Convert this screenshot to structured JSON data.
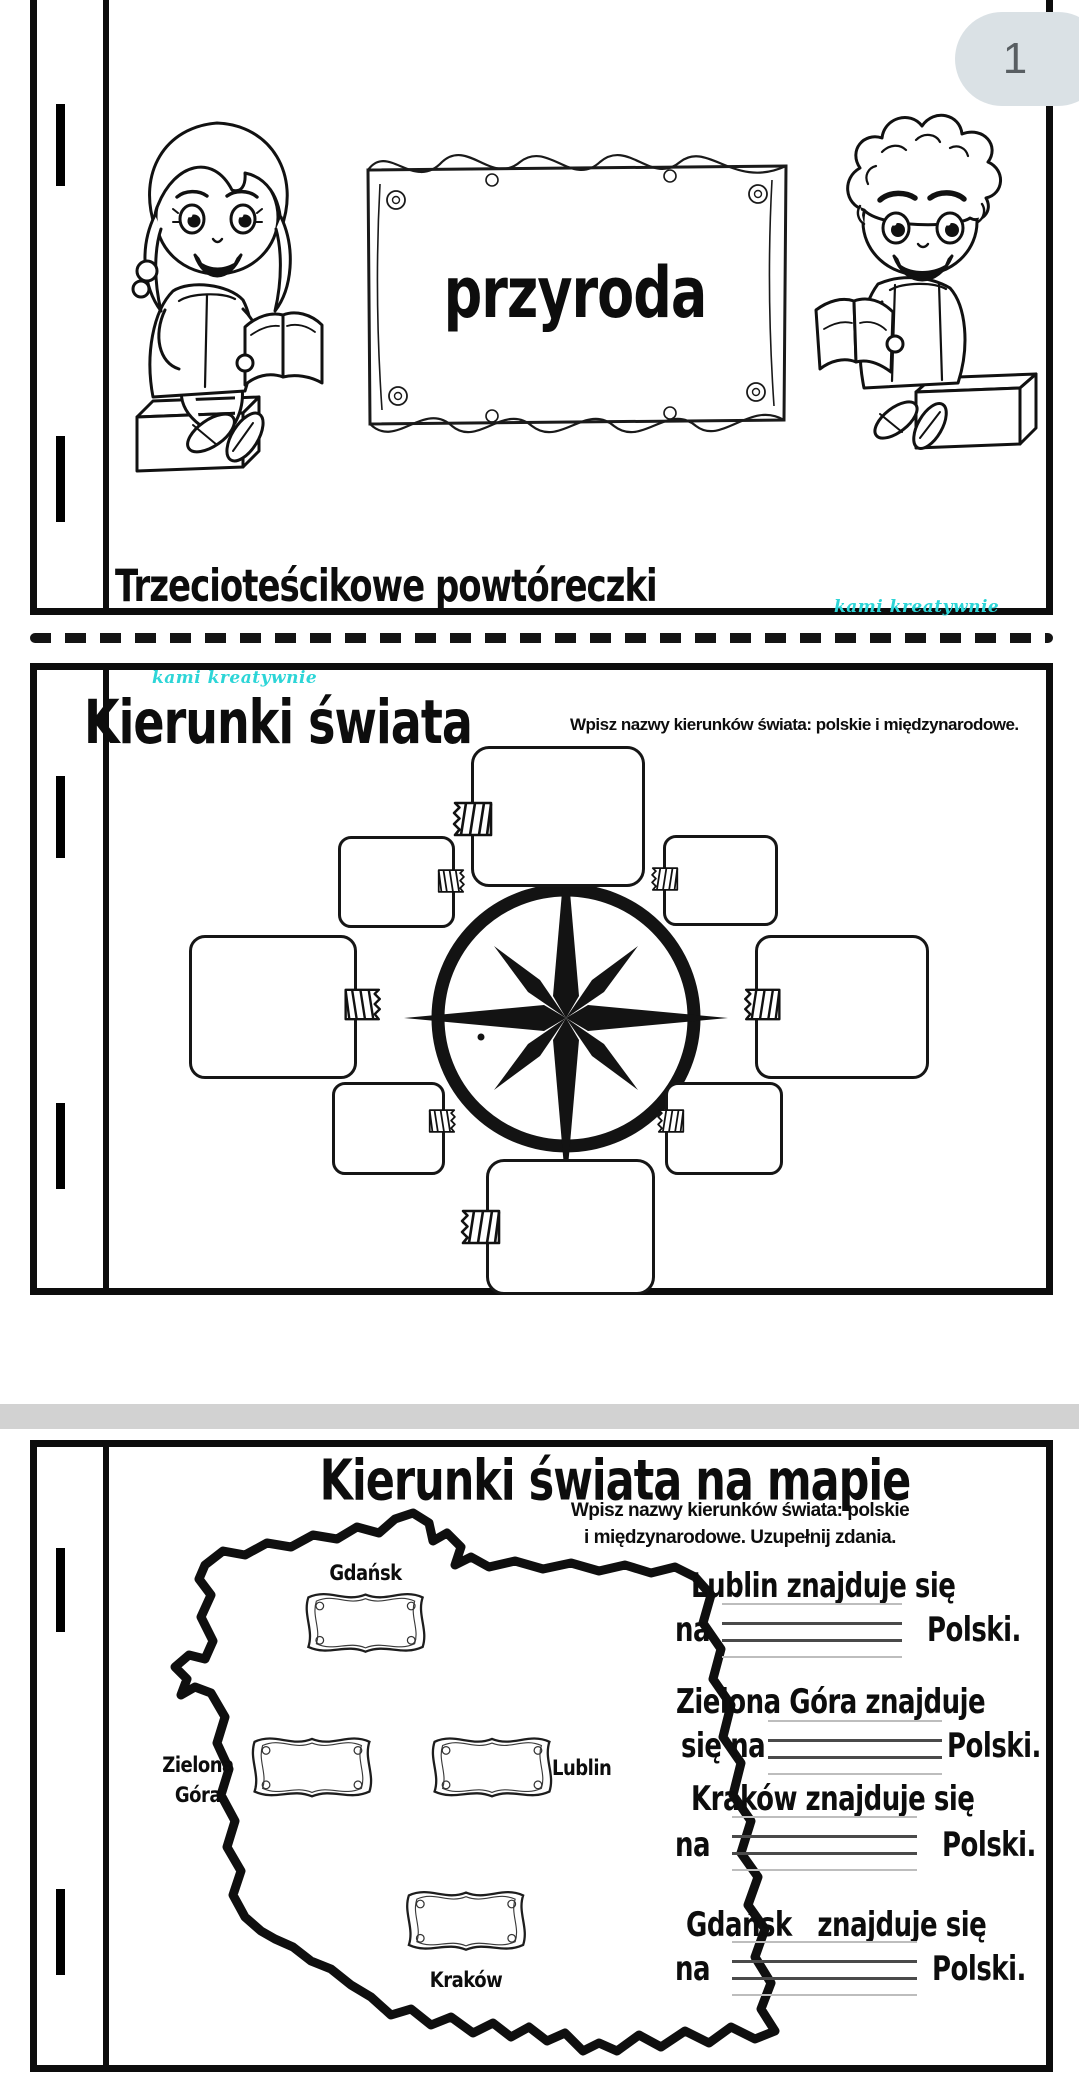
{
  "viewer": {
    "page_badge": "1",
    "badge_bg": "#dae1e5",
    "badge_text_color": "#585e62"
  },
  "brand": {
    "watermark": "kami kreatywnie",
    "accent_color": "#2dd5d7"
  },
  "divider": {
    "gap_band_color": "#d2d2d2"
  },
  "page1": {
    "title": "przyroda",
    "footer": "Trzecioteścikowe powtóreczki"
  },
  "page2": {
    "title": "Kierunki świata",
    "instruction": "Wpisz nazwy kierunków świata: polskie i międzynarodowe."
  },
  "page3": {
    "title": "Kierunki świata na mapie",
    "instruction_line1": "Wpisz nazwy kierunków świata: polskie",
    "instruction_line2": "i międzynarodowe. Uzupełnij zdania.",
    "city_labels": {
      "gdansk": "Gdańsk",
      "zielona_gora_line1": "Zielona",
      "zielona_gora_line2": "Góra",
      "lublin": "Lublin",
      "krakow": "Kraków"
    },
    "sentences": [
      {
        "line1": "Lublin znajduje się",
        "pre": "na",
        "post": "Polski."
      },
      {
        "line1": "Zielona Góra znajduje",
        "pre": "się na",
        "post": "Polski."
      },
      {
        "line1": "Kraków znajduje się",
        "pre": "na",
        "post": "Polski."
      },
      {
        "line1": "Gdańsk   znajduje się",
        "pre": "na",
        "post": "Polski."
      }
    ]
  }
}
